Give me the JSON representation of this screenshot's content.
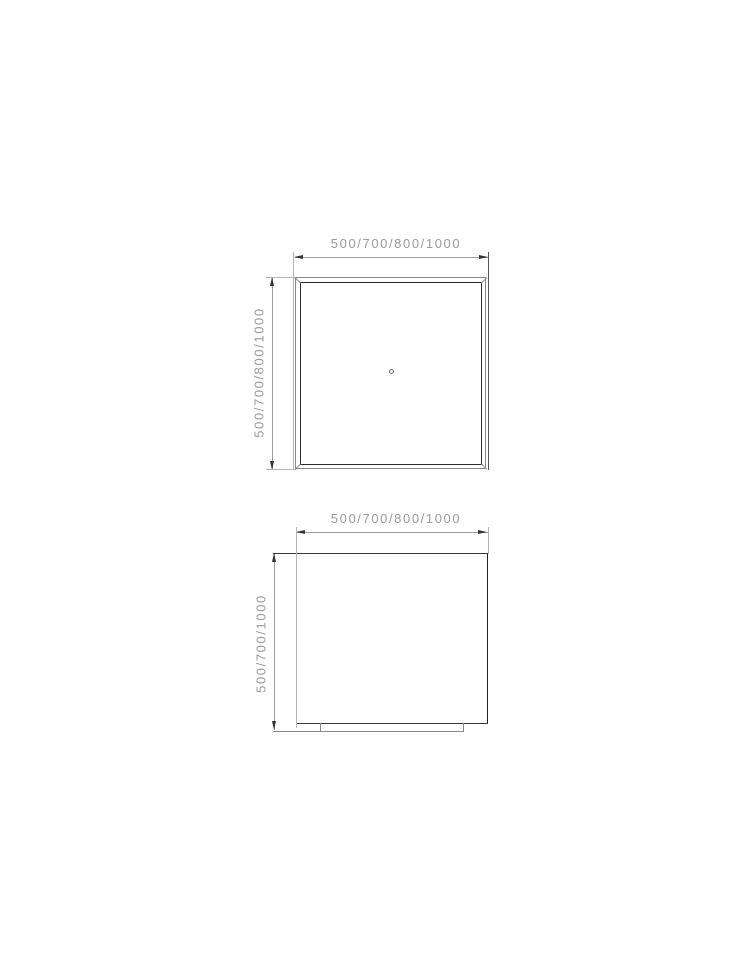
{
  "drawing": {
    "views": {
      "top": {
        "width_label": "500/700/800/1000",
        "height_label": "500/700/800/1000"
      },
      "front": {
        "width_label": "500/700/800/1000",
        "height_label": "500/700/1000"
      }
    },
    "colors": {
      "background": "#ffffff",
      "dimension_text": "#9a9a9a",
      "dimension_line": "#9c9c9c",
      "extension_line": "#b3b3b3",
      "arrowhead": "#333333",
      "outer_outline": "#888888",
      "inner_outline": "#2b2b2b"
    }
  }
}
